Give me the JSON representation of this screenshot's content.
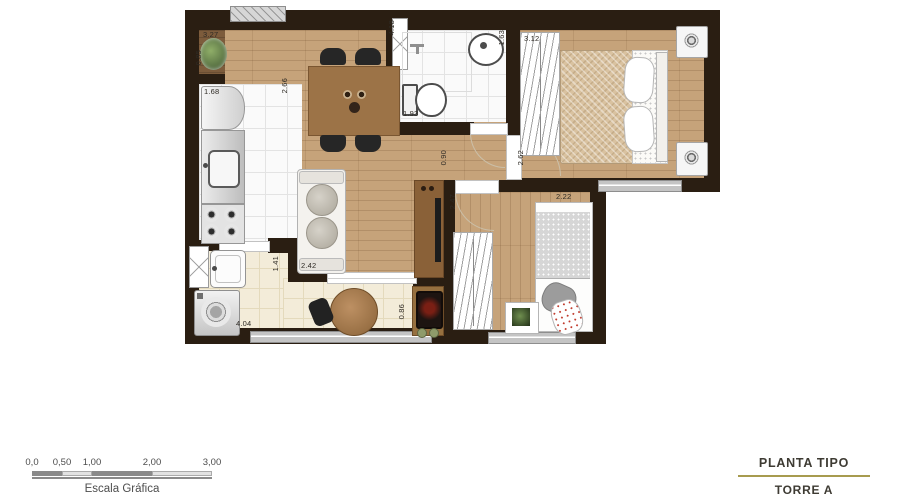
{
  "colors": {
    "wall": "#2a1e12",
    "wood_floor": "#c6a37a",
    "tile_white": "#fafafa",
    "tile_balcony": "#f3ecd9",
    "window_frame": "#c4c4c4",
    "accent_gold": "#a79b4f"
  },
  "dimensions": [
    "3.27",
    "0.85",
    "1.68",
    "2.66",
    "4.18",
    "1.93",
    "1.63",
    "3.12",
    "2.62",
    "0.90",
    "2.47",
    "2.22",
    "2.42",
    "1.41",
    "4.04",
    "0.86"
  ],
  "scale_bar": {
    "ticks": [
      "0,0",
      "0,50",
      "1,00",
      "2,00",
      "3,00"
    ],
    "caption": "Escala Gráfica"
  },
  "title_block": {
    "line1": "PLANTA TIPO",
    "line2": "TORRE A"
  }
}
